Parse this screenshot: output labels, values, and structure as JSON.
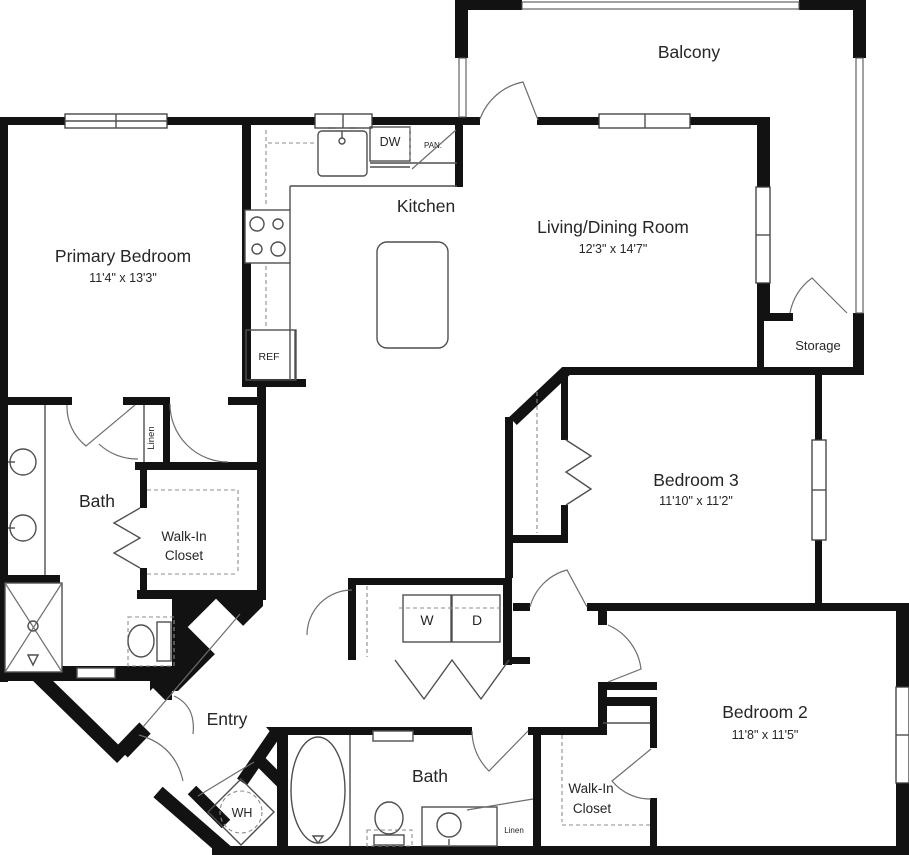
{
  "floorplan": {
    "rooms": {
      "balcony": {
        "label": "Balcony"
      },
      "living_dining": {
        "label": "Living/Dining Room",
        "dims": "12'3\" x 14'7\""
      },
      "kitchen": {
        "label": "Kitchen"
      },
      "primary_bedroom": {
        "label": "Primary Bedroom",
        "dims": "11'4\" x 13'3\""
      },
      "primary_bath": {
        "label": "Bath"
      },
      "primary_walk_in_closet": {
        "line1": "Walk-In",
        "line2": "Closet"
      },
      "primary_linen": {
        "label": "Linen"
      },
      "storage": {
        "label": "Storage"
      },
      "bedroom3": {
        "label": "Bedroom 3",
        "dims": "11'10\" x 11'2\""
      },
      "bedroom2": {
        "label": "Bedroom 2",
        "dims": "11'8\" x 11'5\""
      },
      "bath2": {
        "label": "Bath"
      },
      "bedroom2_walk_in_closet": {
        "line1": "Walk-In",
        "line2": "Closet"
      },
      "bath2_linen": {
        "label": "Linen"
      },
      "entry": {
        "label": "Entry"
      }
    },
    "appliances": {
      "washer": "W",
      "dryer": "D",
      "dishwasher": "DW",
      "pantry": "PAN.",
      "refrigerator": "REF",
      "water_heater": "WH"
    },
    "colors": {
      "wall": "#121212",
      "thin_line": "#4f4f4f",
      "text": "#262626",
      "background": "#ffffff"
    }
  }
}
